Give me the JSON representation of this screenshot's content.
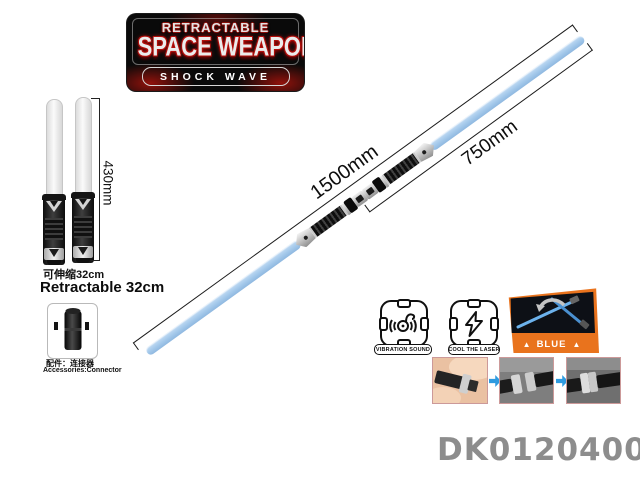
{
  "product_code": "DK01204002",
  "logo": {
    "line1": "RETRACTABLE",
    "line2": "SPACE WEAPON",
    "line3": "SHOCK WAVE"
  },
  "small_sabers": {
    "dimension_label": "430mm",
    "caption_cn": "可伸缩32cm",
    "caption_en": "Retractable 32cm"
  },
  "accessory": {
    "caption_cn": "配件：连接器",
    "caption_en": "Accessories:Connector"
  },
  "main_saber": {
    "total_length_label": "1500mm",
    "half_length_label": "750mm"
  },
  "feature_badges": [
    {
      "icon": "vibration-sound-icon",
      "label": "VIBRATION SOUND"
    },
    {
      "icon": "lightning-bolt-icon",
      "label": "COOL THE LASER"
    }
  ],
  "color_badge": {
    "label": "BLUE",
    "marker": "▲"
  },
  "colors": {
    "blade_blue": "#a3c8ea",
    "badge_orange": "#e9731d",
    "arrow_blue": "#2f9be0",
    "logo_red": "#b40f0c",
    "code_gray": "#8d8d8d"
  }
}
